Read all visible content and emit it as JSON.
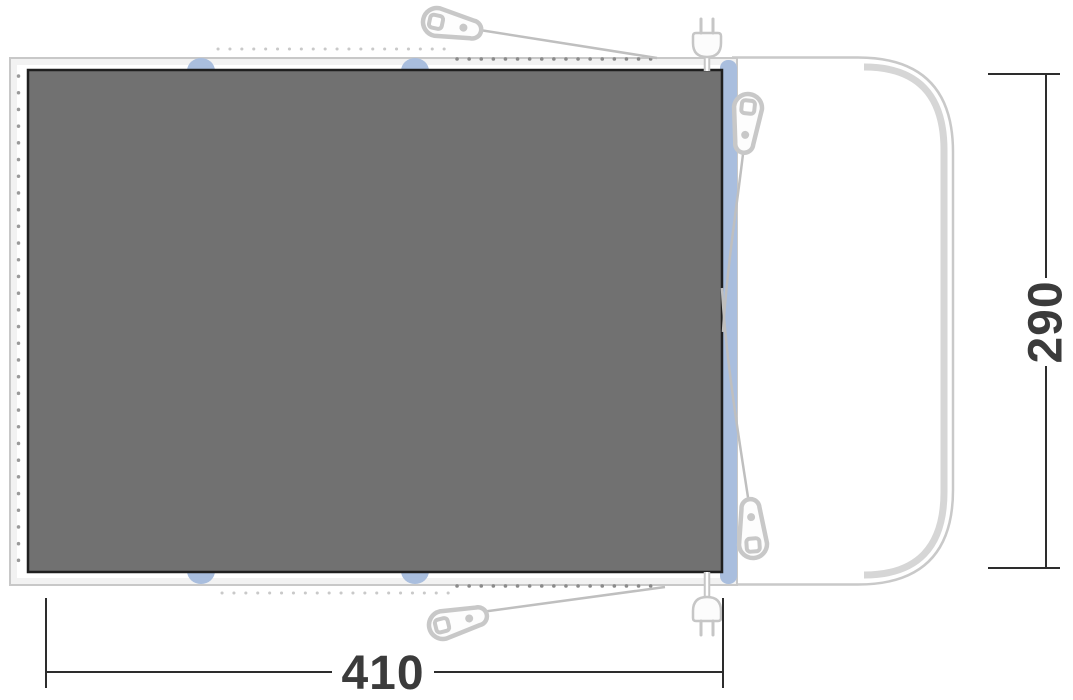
{
  "diagram": {
    "type": "awning-groundsheet-floorplan-top-view",
    "dimensions": {
      "width": {
        "label": "410"
      },
      "height": {
        "label": "290"
      }
    },
    "colors": {
      "groundsheet_fill": "#717171",
      "groundsheet_border": "#1f1f1f",
      "footprint_fill": "#f2f2f2",
      "outline_gray": "#c8c8c8",
      "rail_band_gray": "#d6d6d6",
      "attachment_blue": "#a9bede",
      "dimension_line": "#2d2d2d",
      "dimension_text": "#3b3b3b",
      "peg_dot_dark": "#8a8a8a",
      "peg_dot_light": "#c9c9c9"
    },
    "icons": [
      {
        "name": "tent-peg-icon",
        "count": 4
      },
      {
        "name": "power-plug-icon",
        "count": 2
      },
      {
        "name": "vehicle-outline",
        "count": 1
      },
      {
        "name": "attachment-tab",
        "count": 4
      }
    ]
  }
}
